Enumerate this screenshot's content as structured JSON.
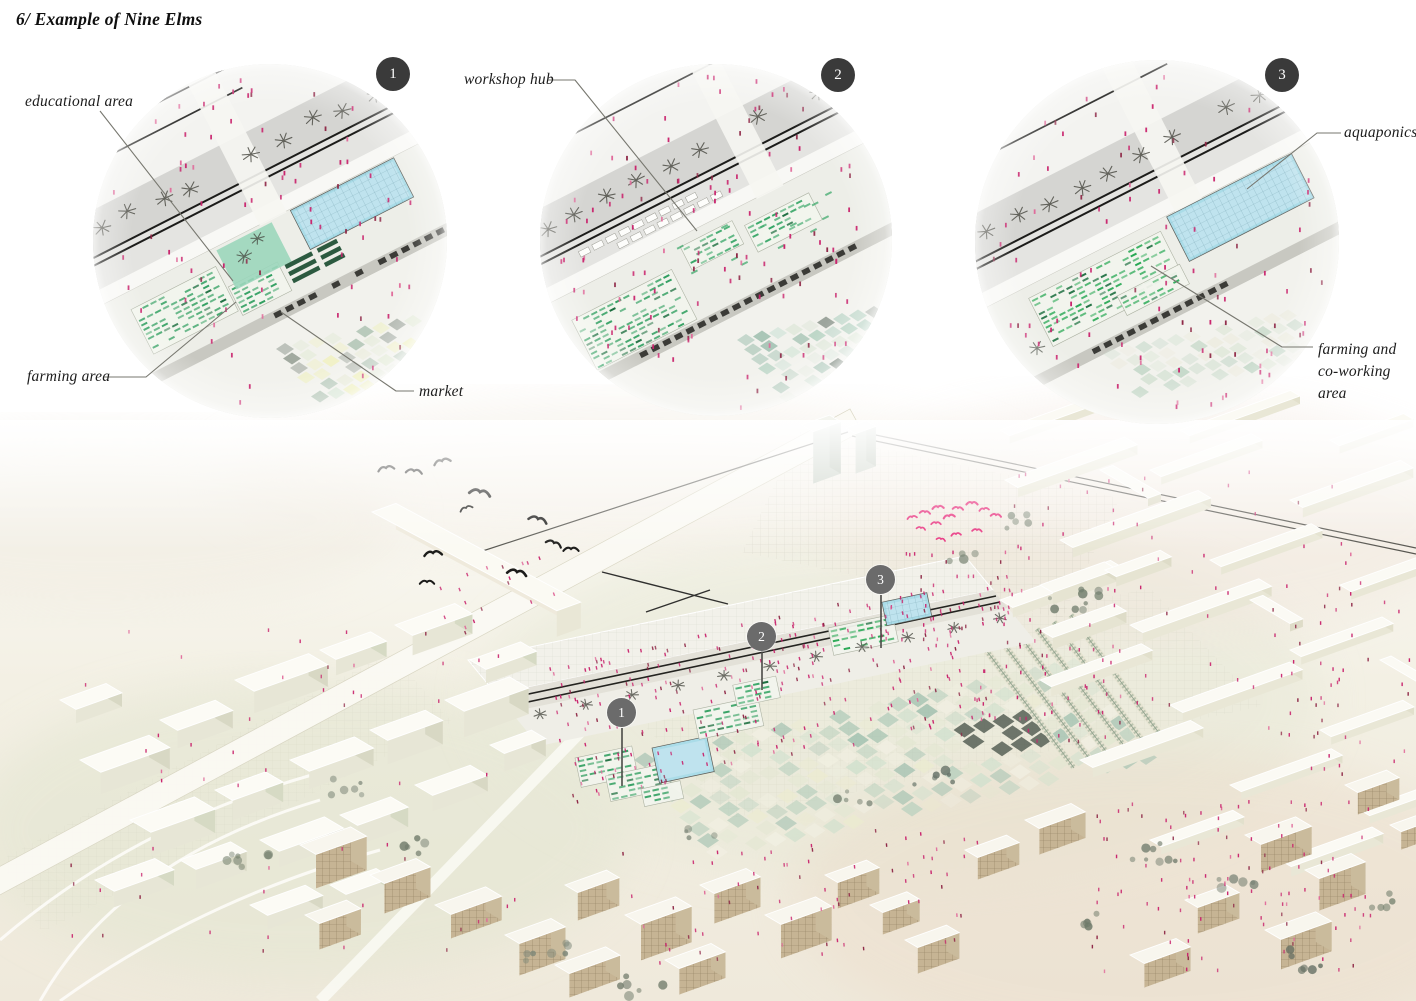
{
  "title": "6/ Example of Nine Elms",
  "vignettes": [
    {
      "number": "1",
      "labels": {
        "educational": "educational area",
        "farming": "farming area",
        "market": "market"
      }
    },
    {
      "number": "2",
      "labels": {
        "workshop": "workshop hub"
      }
    },
    {
      "number": "3",
      "labels": {
        "aquaponics": "aquaponics",
        "coworking": "farming and\nco-working area"
      }
    }
  ],
  "map_markers": [
    {
      "number": "1"
    },
    {
      "number": "2"
    },
    {
      "number": "3"
    }
  ],
  "palette": {
    "figure_pink": "#c9246d",
    "figure_dark": "#8e2746",
    "bird_pink": "#e8317e",
    "badge_dark": "#3a3a3a",
    "marker_gray": "#6b6b6b",
    "farm_green": "#2f9e5f",
    "pool_blue": "#aadce8",
    "teal_green": "#9bd6bb",
    "label_ink": "#1c1c1c"
  }
}
